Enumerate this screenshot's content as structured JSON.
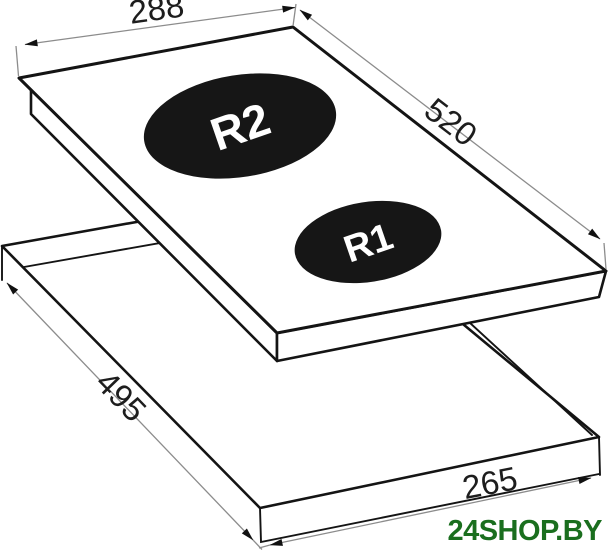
{
  "diagram": {
    "dimensions": {
      "top_width": "288",
      "side_length": "520",
      "cutout_length": "495",
      "cutout_width": "265"
    },
    "burners": {
      "large_label": "R2",
      "small_label": "R1"
    },
    "watermark": "24SHOP.BY",
    "colors": {
      "line": "#141414",
      "dimension_line": "#8c8c8c",
      "burner_fill": "#161616",
      "burner_text": "#ffffff",
      "watermark_green": "#1a6e1e",
      "background": "#ffffff"
    }
  }
}
